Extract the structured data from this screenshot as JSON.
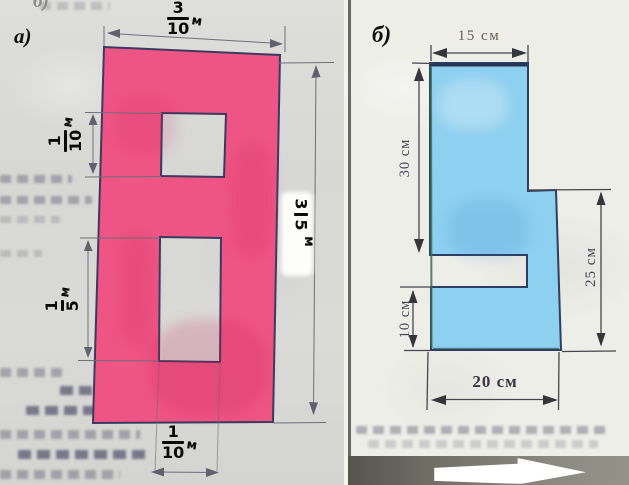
{
  "corner_fragment": "б)",
  "figure_a": {
    "panel_label": "а)",
    "fill": "#ee5584",
    "outline": "#3c3a5e",
    "dim_top": {
      "num": "3",
      "den": "10",
      "unit": "м"
    },
    "dim_hole_upper": {
      "num": "1",
      "den": "10",
      "unit": "м"
    },
    "dim_hole_lower": {
      "num": "1",
      "den": "5",
      "unit": "м"
    },
    "dim_right": {
      "num": "3",
      "den": "5",
      "unit": "м"
    },
    "dim_bottom": {
      "num": "1",
      "den": "10",
      "unit": "м"
    }
  },
  "figure_b": {
    "panel_label": "б)",
    "fill": "#8ed0f0",
    "outline": "#2e3e62",
    "dim_top": "15 см",
    "dim_left_upper": "30 см",
    "dim_left_lower": "10 см",
    "dim_right": "25 см",
    "dim_bottom": "20 см"
  }
}
